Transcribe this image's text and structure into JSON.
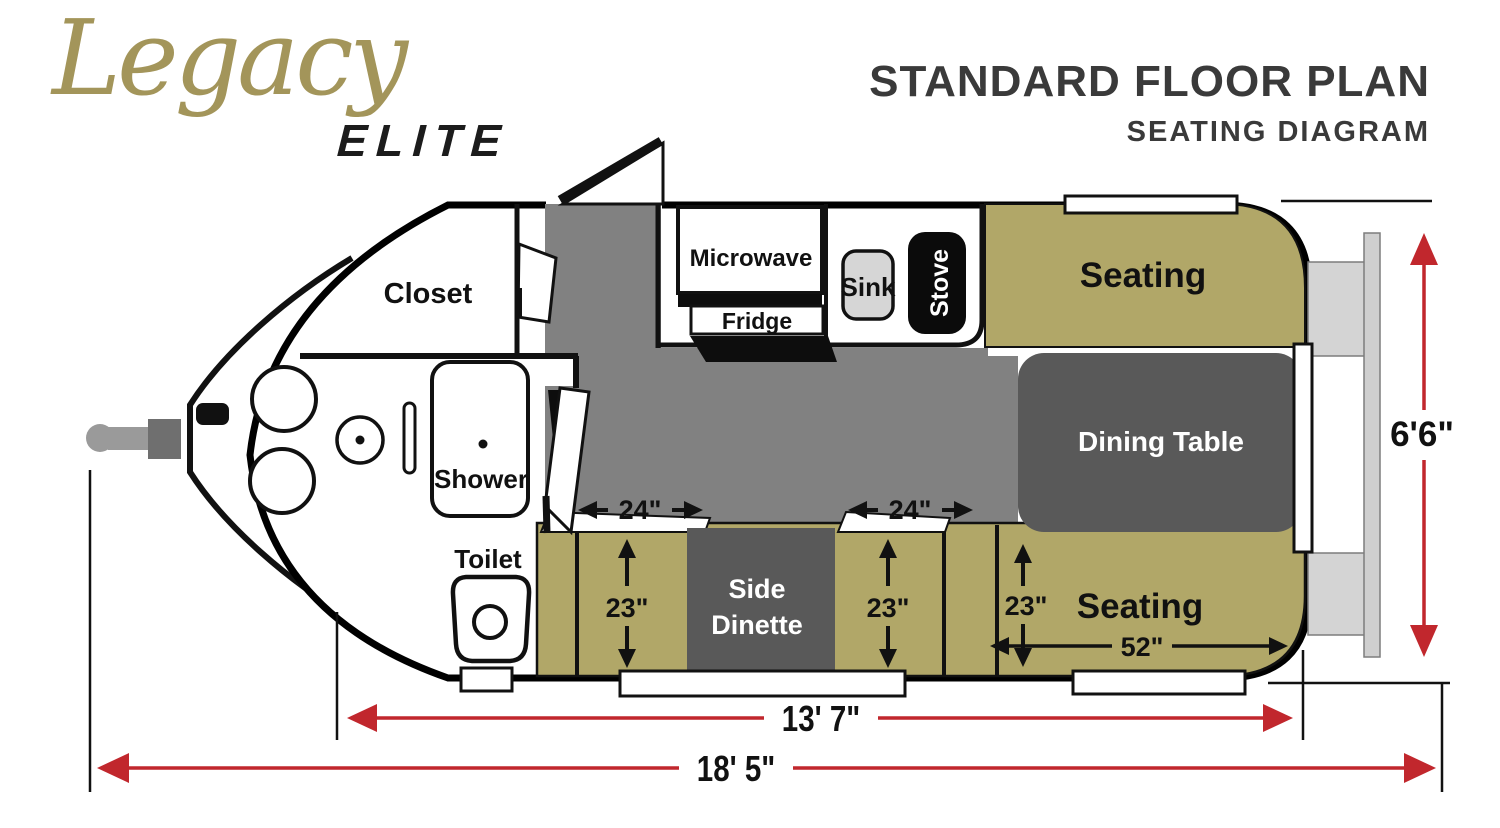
{
  "logo": {
    "brand": "Legacy",
    "model": "ELITE"
  },
  "title": {
    "heading": "STANDARD FLOOR PLAN",
    "subheading": "SEATING DIAGRAM"
  },
  "rooms": {
    "closet": "Closet",
    "shower": "Shower",
    "toilet": "Toilet",
    "microwave": "Microwave",
    "fridge": "Fridge",
    "sink": "Sink",
    "stove": "Stove",
    "seating_front": "Seating",
    "dining_table": "Dining Table",
    "side_dinette_line1": "Side",
    "side_dinette_line2": "Dinette",
    "seating_rear": "Seating"
  },
  "dimensions": {
    "aisle_front": "24\"",
    "aisle_rear": "24\"",
    "bench_depth_1": "23\"",
    "bench_depth_2": "23\"",
    "bench_depth_3": "23\"",
    "rear_seat_width": "52\"",
    "box_length": "13' 7\"",
    "overall_length": "18' 5\"",
    "body_width": "6'6\""
  },
  "colors": {
    "seating_olive": "#b1a768",
    "floor_gray": "#818181",
    "table_gray": "#595959",
    "dimension_red": "#c1272d",
    "logo_gold": "#a3955a",
    "title_gray": "#3a3a3a"
  }
}
